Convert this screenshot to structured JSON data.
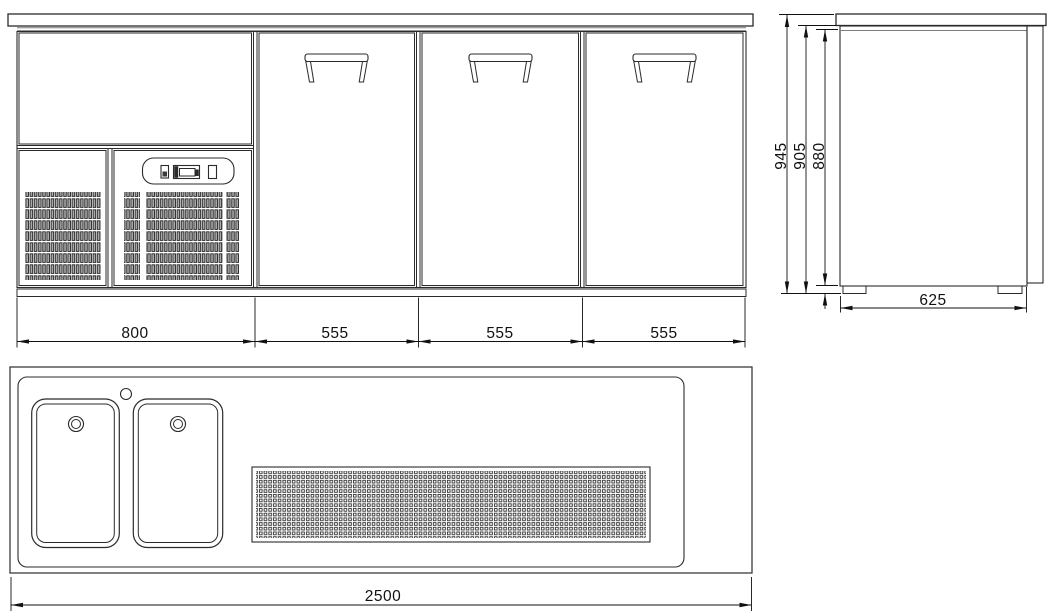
{
  "drawing": {
    "type": "technical-3-view-drawing",
    "front_view": {
      "width_dims": [
        "800",
        "555",
        "555",
        "555"
      ]
    },
    "side_view": {
      "height_dims": [
        "945",
        "905",
        "880"
      ],
      "depth_dim": "625"
    },
    "plan_view": {
      "total_width_dim": "2500"
    },
    "colors": {
      "line": "#2b2b2b",
      "dimension_line": "#111111",
      "light_gray_line": "#7d7d7d",
      "grille_fill": "#a8a8a8",
      "background": "#ffffff"
    }
  }
}
